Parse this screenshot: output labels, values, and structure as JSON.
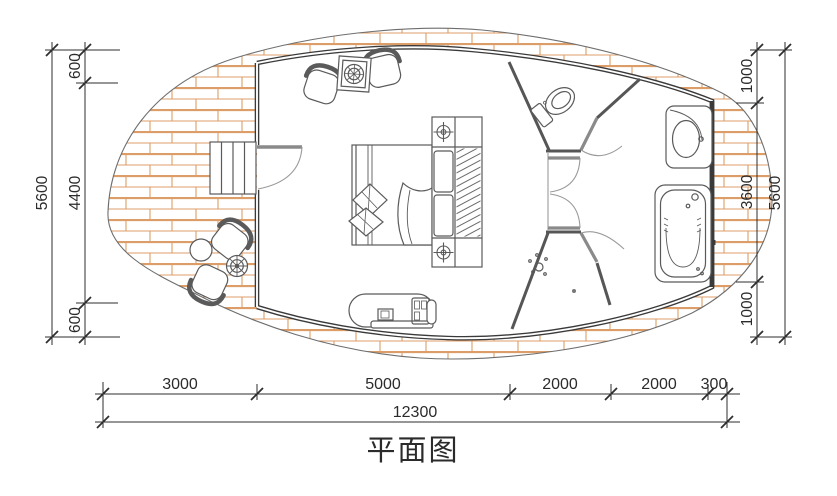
{
  "title": "平面图",
  "dimensions": {
    "left": {
      "segments": [
        "600",
        "4400",
        "600"
      ],
      "total": "5600"
    },
    "right": {
      "segments": [
        "1000",
        "3600",
        "1000"
      ],
      "total": "5600"
    },
    "bottom": {
      "segments": [
        "3000",
        "5000",
        "2000",
        "2000",
        "300"
      ],
      "total": "12300"
    }
  },
  "colors": {
    "deck_brick": "#dc9d68",
    "wall": "#3a3a3a",
    "partition": "#565656",
    "door": "#8a8a8a",
    "furniture_line": "#5a5a5a",
    "dimension": "#2e2e2e"
  },
  "icons": {
    "bed": "double-bed-plan-symbol",
    "toilet": "toilet-plan-symbol",
    "bathtub": "bathtub-plan-symbol",
    "sink": "vanity-sink-plan-symbol",
    "shower": "shower-spray-symbol",
    "stairs": "entry-steps-symbol",
    "lamp": "ceiling-lamp-symbol"
  }
}
